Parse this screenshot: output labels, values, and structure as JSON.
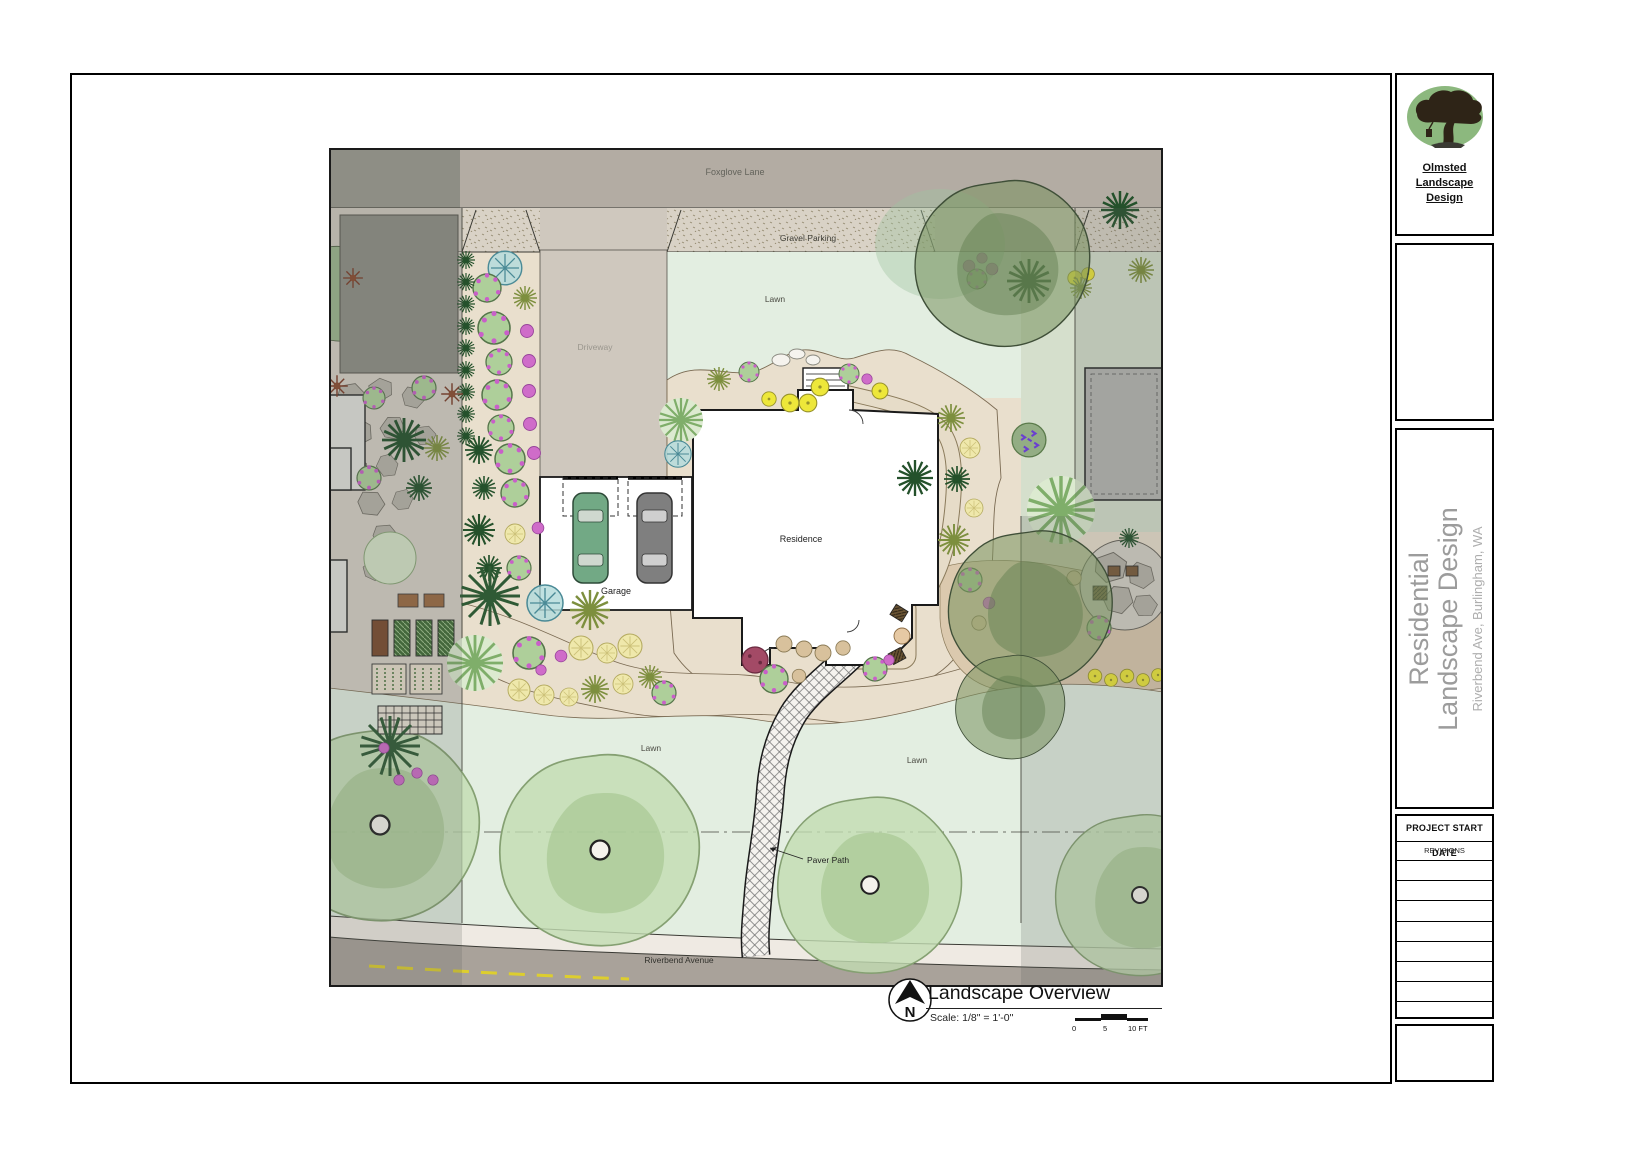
{
  "title_block": {
    "company_name": "Olmsted Landscape Design",
    "project_title_line1": "Residential",
    "project_title_line2": "Landscape Design",
    "project_address": "Riverbend Ave, Burlingham, WA",
    "project_start_date_label": "PROJECT START DATE",
    "revisions_label": "REVISIONS",
    "revision_row_count": 8
  },
  "plan_labels": {
    "foxglove_lane": "Foxglove Lane",
    "gravel_parking": "Gravel Parking",
    "lawn_top": "Lawn",
    "driveway": "Driveway",
    "residence": "Residence",
    "garage": "Garage",
    "lawn_bottom_left": "Lawn",
    "lawn_bottom_right": "Lawn",
    "paver_path": "Paver Path",
    "riverbend_avenue": "Riverbend Avenue"
  },
  "view_title_block": {
    "view_title": "Landscape Overview",
    "scale_text": "Scale: 1/8\" = 1'-0\"",
    "north_label": "N",
    "scale_bar_ticks": [
      "0",
      "5",
      "10 FT"
    ]
  },
  "colors": {
    "logo_green": "#8cb87e",
    "lawn_light": "#e3eee1",
    "bed_beige": "#e9dfcd",
    "road_gray": "#a9a29a",
    "driveway_gray": "#cfc8be",
    "gravel_beige": "#d9d2c6",
    "canopy_olive": "#78925f",
    "street_tree_green": "#c2dcb2",
    "accent_yellow": "#ede73a",
    "accent_magenta": "#cf6cc9"
  }
}
